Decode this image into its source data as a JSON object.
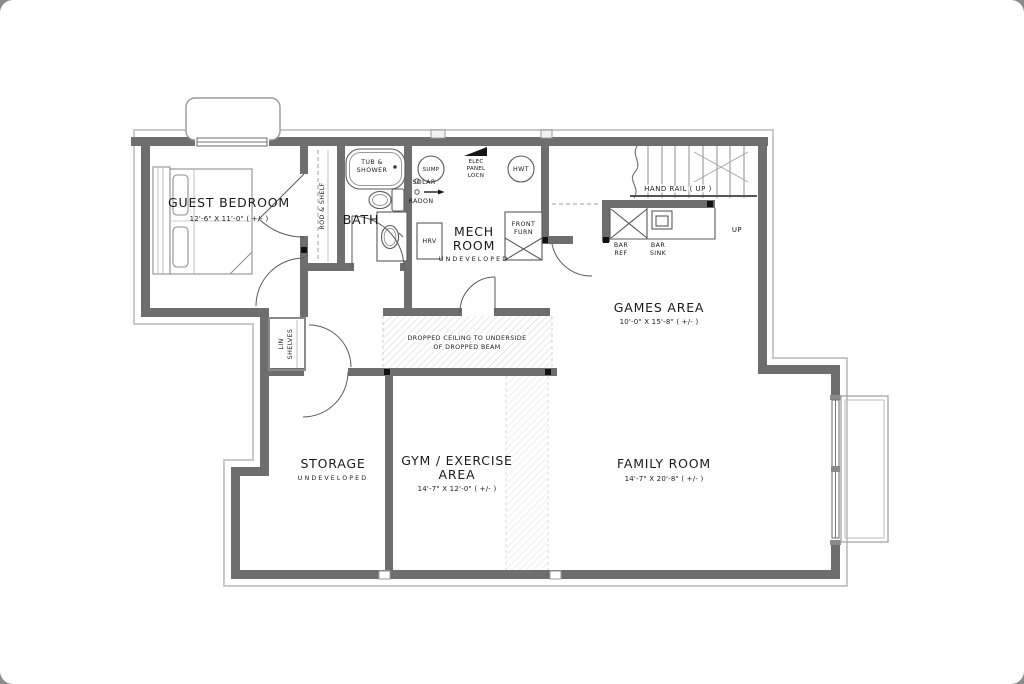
{
  "plan": {
    "rooms": {
      "guest_bedroom": {
        "name": "GUEST BEDROOM",
        "dims": "12'-6\" X 11'-0\" ( +/- )"
      },
      "bath": {
        "name": "BATH"
      },
      "mech": {
        "line1": "MECH",
        "line2": "ROOM",
        "status": "UNDEVELOPED"
      },
      "games": {
        "name": "GAMES AREA",
        "dims": "10'-0\" X 15'-8\" ( +/- )"
      },
      "storage": {
        "name": "STORAGE",
        "status": "UNDEVELOPED"
      },
      "gym": {
        "line1": "GYM / EXERCISE",
        "line2": "AREA",
        "dims": "14'-7\" X 12'-0\" ( +/- )"
      },
      "family": {
        "name": "FAMILY ROOM",
        "dims": "14'-7\" X 20'-8\" ( +/- )"
      }
    },
    "fixtures": {
      "tub1": "TUB &",
      "tub2": "SHOWER",
      "sump": "SUMP",
      "hwt": "HWT",
      "hrv": "HRV",
      "elec1": "ELEC",
      "elec2": "PANEL",
      "elec3": "LOCN",
      "solar": "SOLAR",
      "radon": "RADON",
      "furn1": "FRONT",
      "furn2": "FURN",
      "bar_ref1": "BAR",
      "bar_ref2": "REF",
      "bar_sink1": "BAR",
      "bar_sink2": "SINK"
    },
    "annotations": {
      "hand_rail": "HAND RAIL ( UP )",
      "up": "UP",
      "rod_shelf": "ROD & SHELF",
      "lin1": "LIN",
      "lin2": "SHELVES",
      "dc1": "DROPPED CEILING TO UNDERSIDE",
      "dc2": "OF DROPPED BEAM"
    },
    "colors": {
      "wall": "#6e6e6e",
      "footing": "#c9c9c9",
      "text": "#1b1b1b",
      "paper": "#ffffff"
    }
  }
}
